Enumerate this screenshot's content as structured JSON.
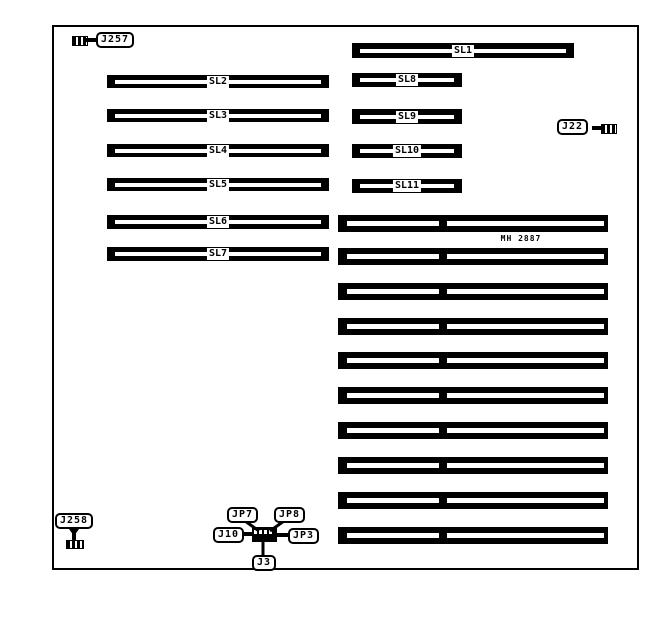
{
  "colors": {
    "foreground": "#000000",
    "background": "#ffffff"
  },
  "slots": {
    "sl1": "SL1",
    "sl2": "SL2",
    "sl3": "SL3",
    "sl4": "SL4",
    "sl5": "SL5",
    "sl6": "SL6",
    "sl7": "SL7",
    "sl8": "SL8",
    "sl9": "SL9",
    "sl10": "SL10",
    "sl11": "SL11"
  },
  "chip": {
    "label": "MH 2887"
  },
  "connectors": {
    "j257": "J257",
    "j22": "J22",
    "j258": "J258",
    "jp7": "JP7",
    "jp8": "JP8",
    "j10": "J10",
    "jp3": "JP3",
    "j3": "J3"
  },
  "memory_sockets": {
    "count": 10
  }
}
